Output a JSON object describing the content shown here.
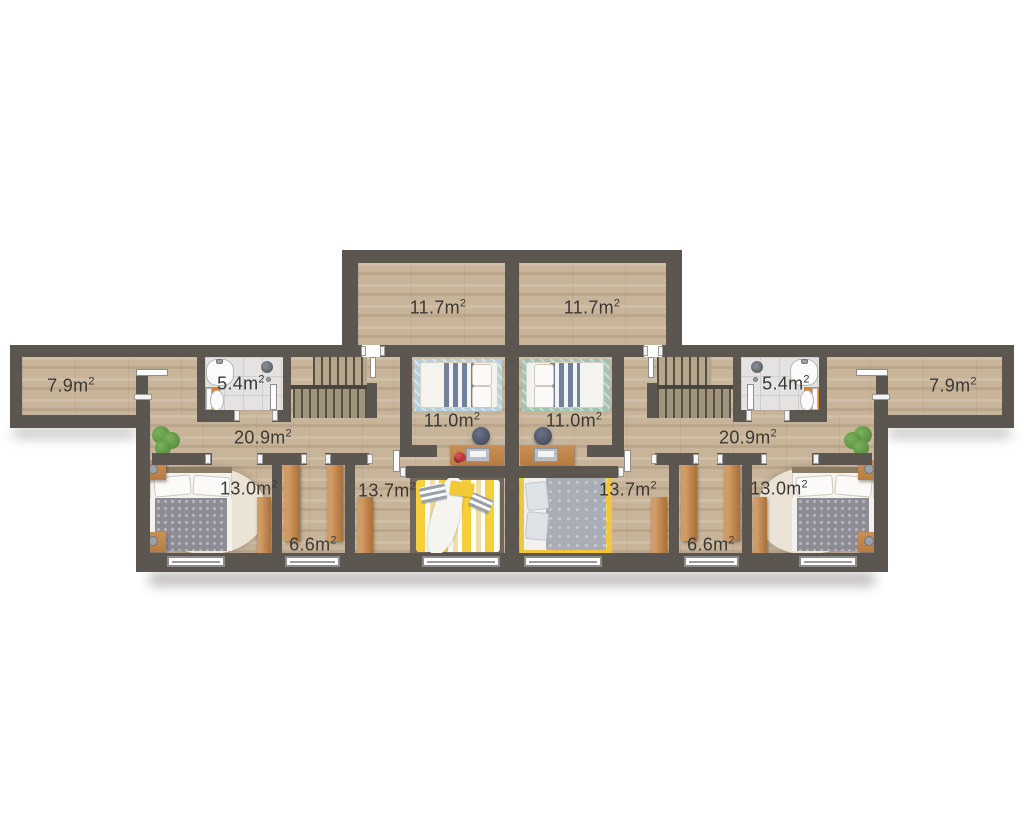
{
  "plan": {
    "name": "upper-floor-plan-duplex",
    "area_unit": "m",
    "area_sup": "2",
    "units": {
      "left": {
        "attic_room": "11.7",
        "side_room": "7.9",
        "bathroom": "5.4",
        "hallway": "20.9",
        "bedroom_main": "13.0",
        "wardrobe": "6.6",
        "bedroom_second": "13.7",
        "bedroom_third": "11.0"
      },
      "right": {
        "attic_room": "11.7",
        "side_room": "7.9",
        "bathroom": "5.4",
        "hallway": "20.9",
        "bedroom_main": "13.0",
        "wardrobe": "6.6",
        "bedroom_second": "13.7",
        "bedroom_third": "11.0"
      }
    },
    "colors": {
      "wall": "#5b564f",
      "wood_floor": "#c8b499",
      "tile_floor": "#e4e3e1",
      "wardrobe_wood": "#c08650",
      "accent_orange": "#d9842e",
      "rug_blue": "#b6d0db",
      "rug_teal": "#a0c3b8",
      "rug_dark": "#6f6760",
      "rug_yellow": "#efc73e",
      "duvet_gray": "#8d8c94",
      "duvet_yellow": "#f6cf3a",
      "plant_green": "#5f9e4a",
      "label_text": "#3a3936"
    }
  }
}
